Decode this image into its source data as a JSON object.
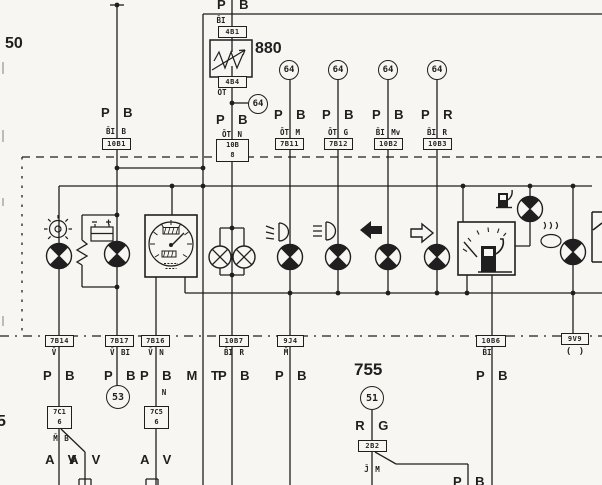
{
  "sheet": {
    "margin_ref_top": "50",
    "margin_ref_bottom": "5"
  },
  "icons": {
    "brake_warning": "circle-with-radial-ticks-icon",
    "battery": "battery-icon",
    "speedometer": "speedometer-gauge-icon",
    "panel_bulbs": "bulb-x-icon",
    "fog_light": "fog-light-icon",
    "high_beam": "high-beam-icon",
    "turn_left": "arrow-left-icon",
    "turn_right": "arrow-right-icon",
    "fuel_pump": "fuel-pump-icon",
    "fuel_gauge": "fuel-gauge-icon",
    "choke": "choke-oval-icon",
    "warning_lamp": "quadrant-lamp-icon"
  },
  "top": {
    "supply_wire": {
      "colors": "P B",
      "code": "B̄I B",
      "connector": "10B1"
    },
    "dimmer_branch": {
      "colors_top": "P B",
      "code_top": "B̄I",
      "connector_top": "4B1",
      "component": "880",
      "connector_bottom": "4B4",
      "code_below": "ŌT",
      "ref": "64",
      "colors": "P B",
      "code": "ŌT N",
      "connector_main_l1": "10B",
      "connector_main_l2": "8"
    },
    "lamp_feeds": [
      {
        "ref": "64",
        "colors": "P B",
        "code": "ŌT M",
        "connector": "7B11"
      },
      {
        "ref": "64",
        "colors": "P B",
        "code": "ŌT G",
        "connector": "7B12"
      },
      {
        "ref": "64",
        "colors": "P B",
        "code": "B̄I Mv",
        "connector": "10B2"
      },
      {
        "ref": "64",
        "colors": "P R",
        "code": "B̄I R",
        "connector": "10B3"
      }
    ]
  },
  "bottom": {
    "exit_brake": {
      "connector": "7B14",
      "code": "V̄",
      "colors": "P B",
      "connector2_l1": "7C1",
      "connector2_l2": "6",
      "code2": "M̄ B",
      "colors2a": "A V",
      "colors2b": "A V"
    },
    "exit_charge": {
      "connector": "7B17",
      "code": "V̄ BI",
      "colors": "P B",
      "ref": "53"
    },
    "exit_speedo": {
      "connector": "7B16",
      "code": "V̄ N",
      "colors": "P B",
      "code_n": "N",
      "connector2_l1": "7C5",
      "connector2_l2": "6",
      "colors2": "A V"
    },
    "wire_mt": {
      "colors": "M T"
    },
    "exit_illum": {
      "connector": "10B7",
      "code": "B̄I R",
      "colors": "P B"
    },
    "exit_ground": {
      "connector": "9J4",
      "code": "M̄",
      "colors": "P B"
    },
    "node_755": {
      "label": "755",
      "ref": "51",
      "colors": "R G",
      "connector": "2B2",
      "code": "J̄ M"
    },
    "exit_fuel": {
      "connector": "10B6",
      "code": "B̄I",
      "colors": "P B"
    },
    "exit_right": {
      "connector": "9V9",
      "code": "( )"
    },
    "partial_colors": "P B"
  }
}
